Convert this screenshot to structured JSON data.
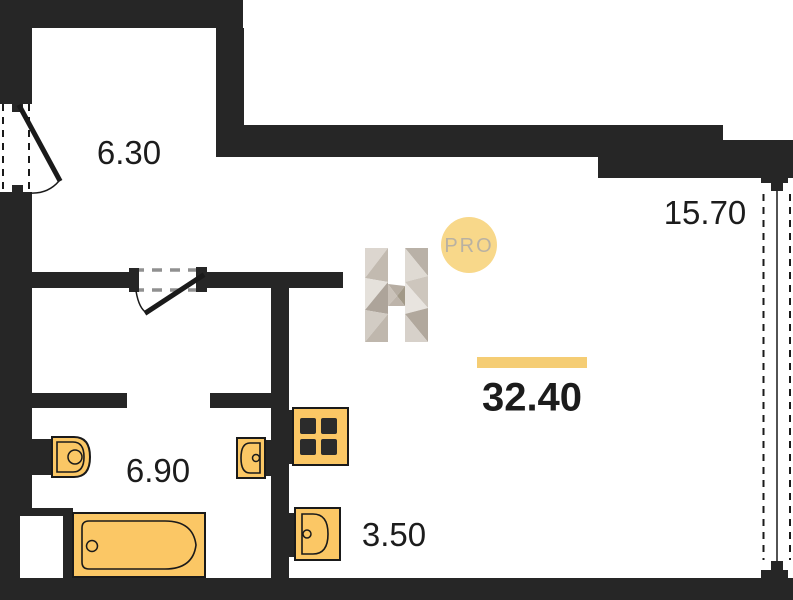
{
  "floorplan": {
    "total_area": "32.40",
    "rooms": {
      "hall": {
        "area": "6.30"
      },
      "living": {
        "area": "15.70"
      },
      "bathroom": {
        "area": "6.90"
      },
      "kitchen": {
        "area": "3.50"
      }
    },
    "logo": {
      "letter": "H",
      "badge_label": "PRO"
    }
  },
  "colors": {
    "wall": "#262626",
    "ink": "#1c1c1c",
    "accent": "#f5cd74",
    "badge": "#f8d88a",
    "badge-text": "#b9b1a2",
    "fixture": "#fbc765",
    "dash-gray": "#909090"
  }
}
